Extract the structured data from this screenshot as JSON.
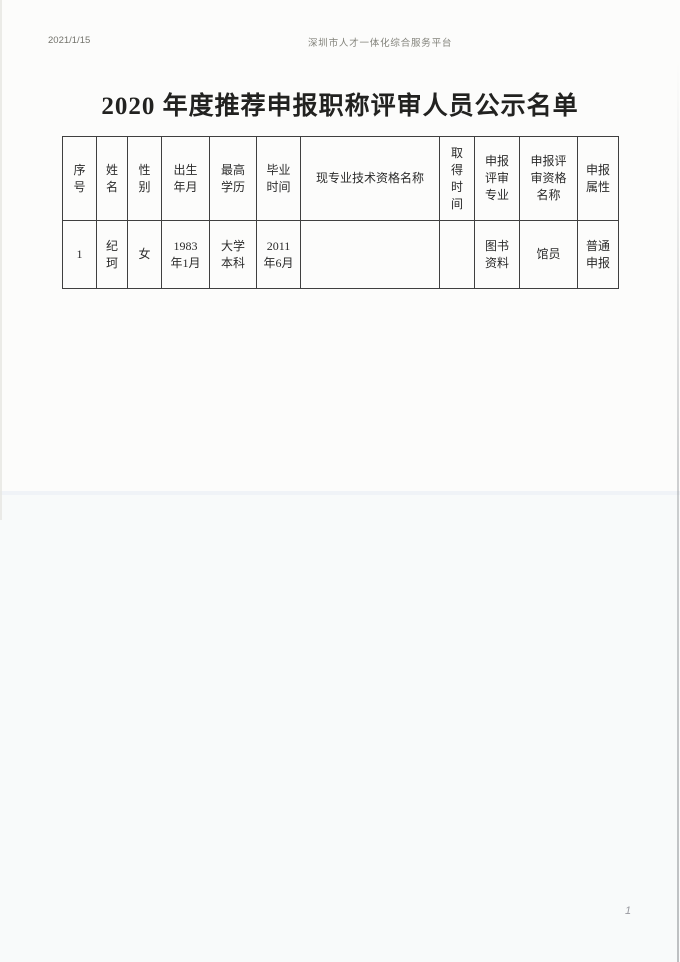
{
  "colors": {
    "paper": "#fcfcfb",
    "ink": "#2b2b2b",
    "table_border": "#3f3f3f",
    "print_header_text": "#83837b"
  },
  "print_header": {
    "date": "2021/1/15",
    "site_name": "深圳市人才一体化综合服务平台"
  },
  "document": {
    "title": "2020 年度推荐申报职称评审人员公示名单",
    "page_number": "1"
  },
  "table": {
    "headers": [
      "序\n号",
      "姓\n名",
      "性\n别",
      "出生\n年月",
      "最高\n学历",
      "毕业\n时间",
      "现专业技术资格名称",
      "取\n得\n时\n间",
      "申报\n评审\n专业",
      "申报评\n审资格\n名称",
      "申报\n属性"
    ],
    "rows": [
      [
        "1",
        "纪\n珂",
        "女",
        "1983\n年1月",
        "大学\n本科",
        "2011\n年6月",
        "",
        "",
        "图书\n资料",
        "馆员",
        "普通\n申报"
      ]
    ]
  }
}
